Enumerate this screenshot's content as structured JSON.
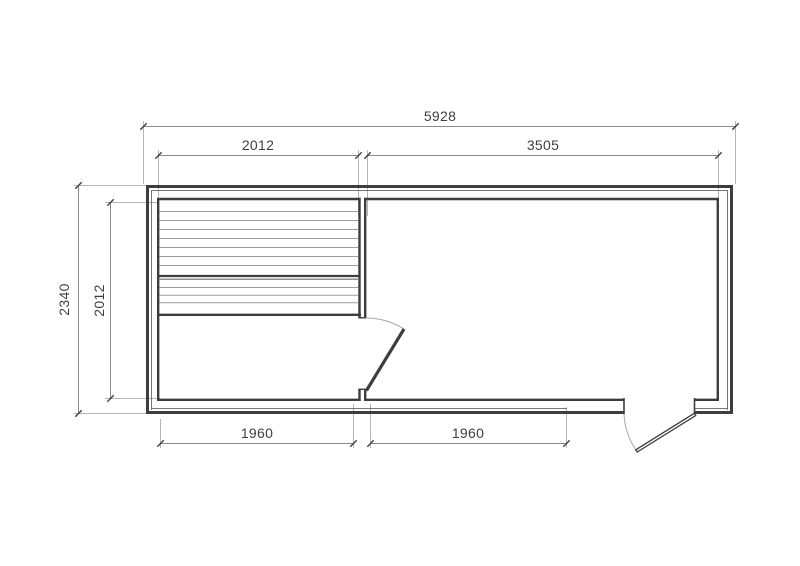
{
  "drawing": {
    "type": "floor-plan",
    "background": "#ffffff",
    "line_colors": {
      "wall": "#3d3d3d",
      "wall_inner_line": "#757575",
      "plank_line": "#9d9d9d",
      "bench_divider": "#3d3d3d",
      "dimension_line": "#8c8c8c",
      "extension_line": "#b5b5b5",
      "door_swing_arc": "#a8a8a8",
      "text": "#3f3f3f"
    },
    "dimensions_mm": {
      "overall_width": "5928",
      "top_left_section": "2012",
      "top_right_section": "3505",
      "overall_depth": "2340",
      "left_inner_depth": "2012",
      "bottom_left_section": "1960",
      "bottom_right_section": "1960"
    }
  }
}
